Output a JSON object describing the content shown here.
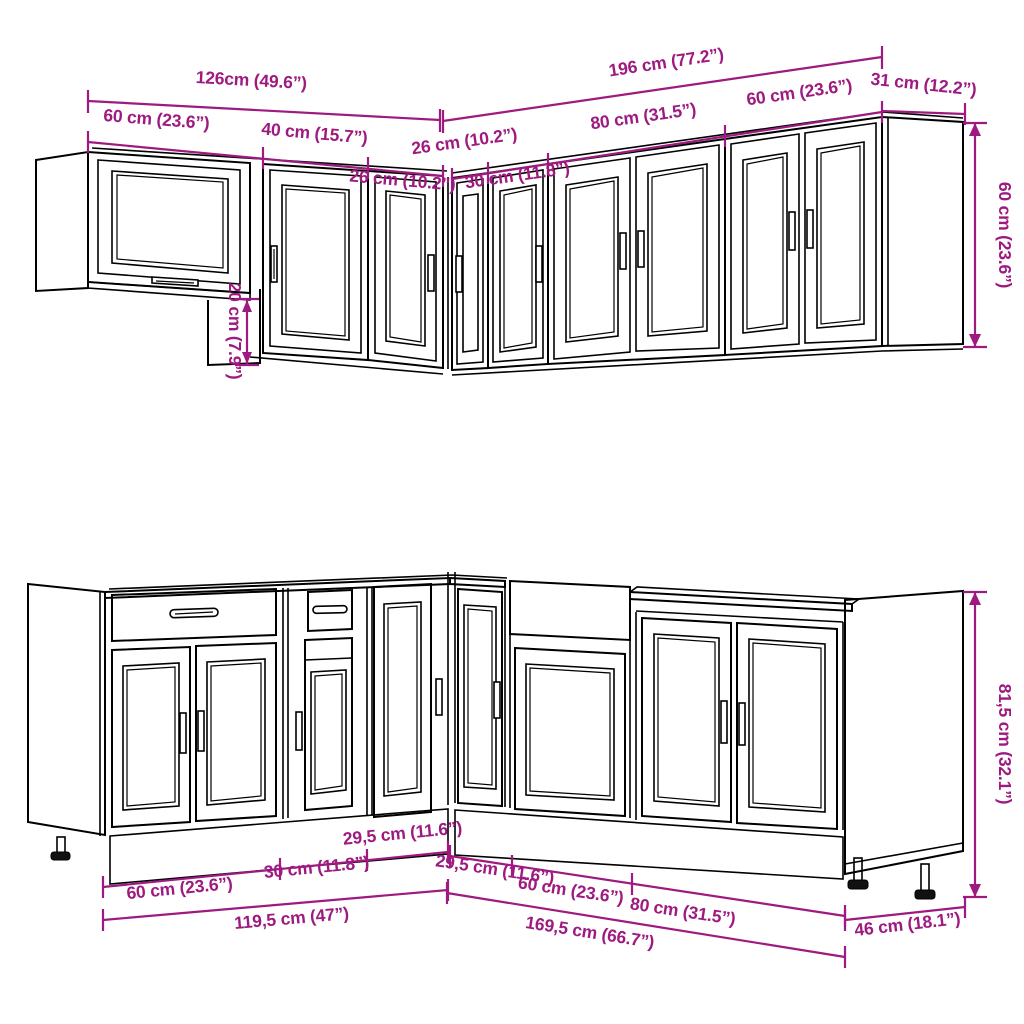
{
  "title": "Kitchen cabinet set – dimension diagram",
  "colors": {
    "dimension_text": "#9e1a80",
    "line": "#000000",
    "background": "#ffffff"
  },
  "top_section": {
    "name": "Wall cabinets",
    "dims": {
      "total_left": "126cm (49.6”)",
      "total_right": "196 cm (77.2”)",
      "depth": "31 cm (12.2”)",
      "height": "60 cm (23.6”)",
      "glass_cabinet_width": "60 cm (23.6”)",
      "cabinet_40_width": "40 cm (15.7”)",
      "corner_left_width": "26 cm (10.2”)",
      "corner_right_width": "26 cm (10.2”)",
      "cabinet_30_width": "30 cm (11.8”)",
      "cabinet_80_width": "80 cm (31.5”)",
      "cabinet_60_width": "60 cm (23.6”)",
      "glass_cabinet_drop": "20 cm (7.9”)"
    }
  },
  "bottom_section": {
    "name": "Base cabinets",
    "dims": {
      "cabinet_60_left_width": "60 cm (23.6”)",
      "cabinet_30_width": "30 cm (11.8”)",
      "corner_left_width": "29,5 cm (11.6”)",
      "corner_right_width": "29,5 cm (11.6”)",
      "cabinet_60_right_width": "60 cm (23.6”)",
      "cabinet_80_width": "80 cm (31.5”)",
      "run_left_total": "119,5 cm (47”)",
      "run_right_total": "169,5 cm (66.7”)",
      "depth": "46 cm (18.1”)",
      "height": "81,5 cm (32.1”)"
    }
  }
}
